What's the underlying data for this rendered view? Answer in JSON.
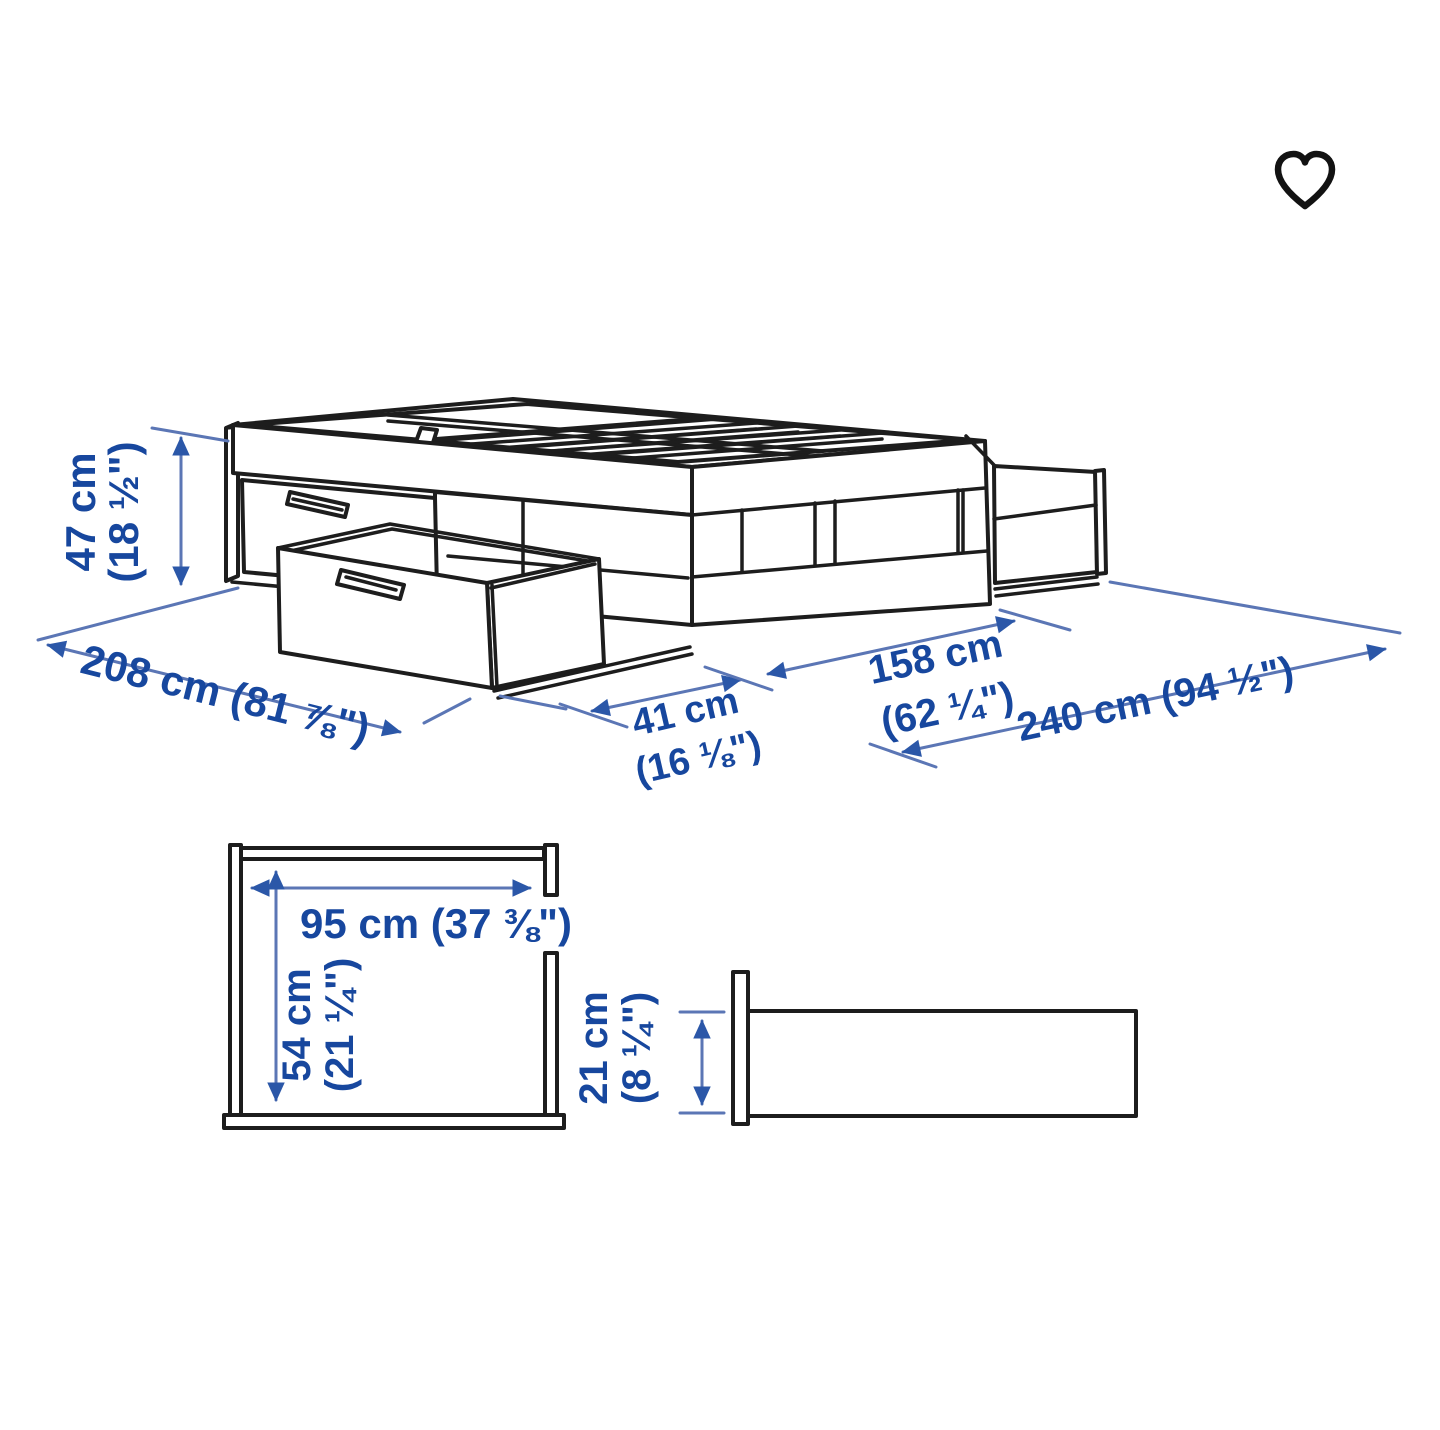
{
  "page": {
    "background": "#ffffff"
  },
  "header": {
    "favorite_icon": "heart-outline"
  },
  "colors": {
    "line_art": "#1d1d1d",
    "dimension_text": "#17479e",
    "dimension_lines": "#5b76b5",
    "arrowhead": "#2b57a8"
  },
  "diagram": {
    "kind": "bed-frame-with-storage-dimension-diagram",
    "dims": {
      "height_cm": "47 cm",
      "height_in": "(18 ½\")",
      "length": "208 cm (81 ⅞\")",
      "pullout_cm": "41 cm",
      "pullout_in": "(16 ⅛\")",
      "width_cm": "158 cm",
      "width_in": "(62 ¼\")",
      "total_width": "240 cm (94 ½\")",
      "drawer_width": "95 cm (37 ⅜\")",
      "drawer_depth_cm": "54 cm",
      "drawer_depth_in": "(21 ¼\")",
      "drawer_height_cm": "21 cm",
      "drawer_height_in": "(8 ¼\")"
    }
  }
}
